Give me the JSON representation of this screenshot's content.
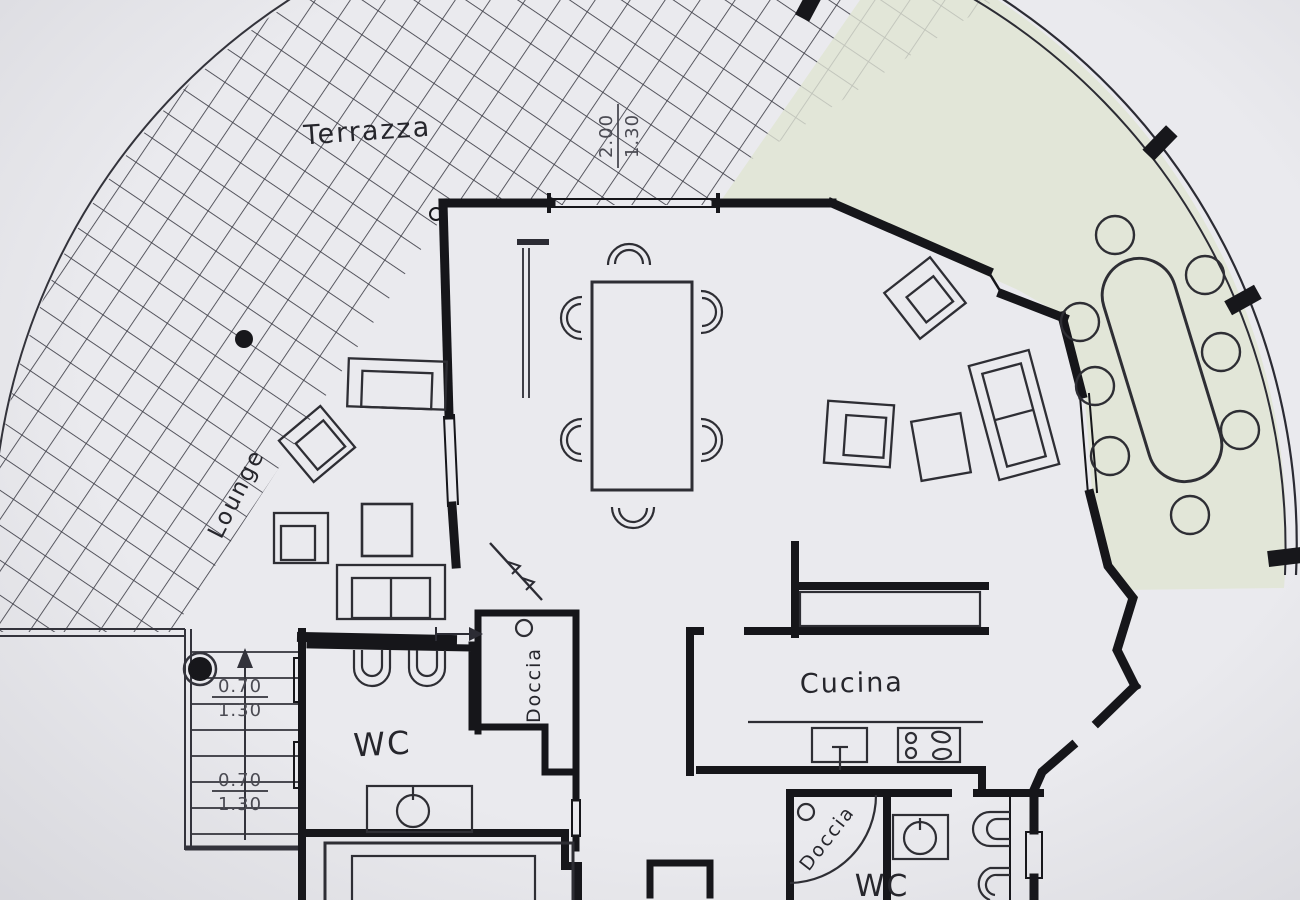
{
  "rooms": {
    "terrace_label": "Terrazza",
    "lounge_label": "Lounge",
    "wc_left_label": "WC",
    "shower_upper_label": "Doccia",
    "kitchen_label": "Cucina",
    "shower_lower_label": "Doccia",
    "wc_right_label": "WC"
  },
  "dimensions": {
    "terrace_door": {
      "width_m": "2.00",
      "height_m": "1.30"
    },
    "stairs_upper": {
      "width_m": "0.70",
      "height_m": "1.30"
    },
    "stairs_lower": {
      "width_m": "0.70",
      "height_m": "1.30"
    }
  },
  "colors": {
    "paper": "#eaeaee",
    "ink": "#17171b",
    "terrace_paving_green": "#e2e6d8"
  }
}
